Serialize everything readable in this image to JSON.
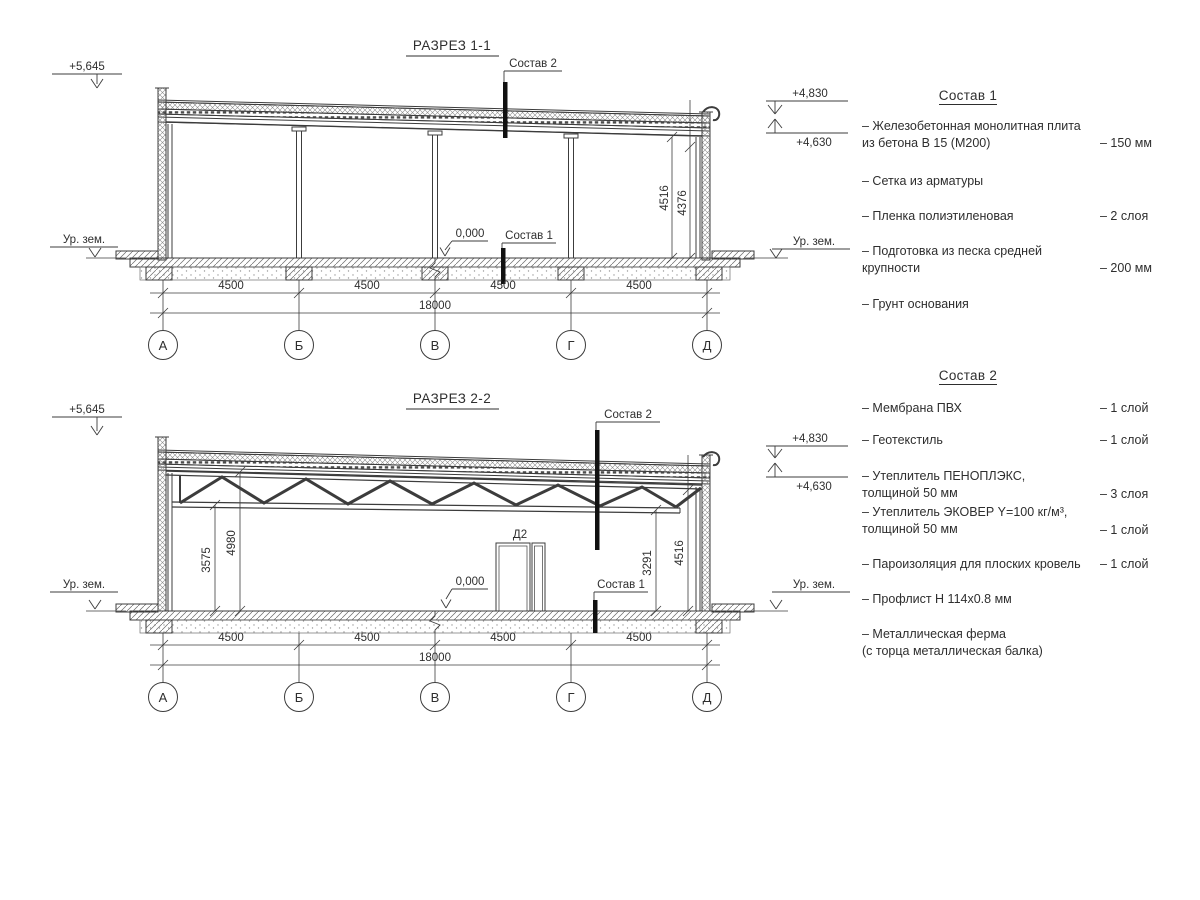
{
  "s1": {
    "title": "РАЗРЕЗ 1-1",
    "callout_top": "Состав 2",
    "callout_bottom": "Состав 1",
    "elev_left": "+5,645",
    "elev_r1": "+4,830",
    "elev_r2": "+4,630",
    "elev_zero": "0,000",
    "ground": "Ур. зем.",
    "vdim1": "4516",
    "vdim2": "4376",
    "span_dims": [
      "4500",
      "4500",
      "4500",
      "4500"
    ],
    "total_dim": "18000",
    "axes": [
      "А",
      "Б",
      "В",
      "Г",
      "Д"
    ]
  },
  "s2": {
    "title": "РАЗРЕЗ 2-2",
    "callout_top": "Состав 2",
    "callout_bottom": "Состав 1",
    "elev_left": "+5,645",
    "elev_r1": "+4,830",
    "elev_r2": "+4,630",
    "elev_zero": "0,000",
    "ground": "Ур. зем.",
    "door_label": "Д2",
    "vdim_left1": "3575",
    "vdim_left2": "4980",
    "vdim_right1": "3291",
    "vdim_right2": "4516",
    "span_dims": [
      "4500",
      "4500",
      "4500",
      "4500"
    ],
    "total_dim": "18000",
    "axes": [
      "А",
      "Б",
      "В",
      "Г",
      "Д"
    ]
  },
  "legend1": {
    "title": "Состав 1",
    "items": [
      {
        "name": "– Железобетонная монолитная плита\nиз бетона В 15 (М200)",
        "value": "– 150 мм"
      },
      {
        "name": "– Сетка из арматуры",
        "value": ""
      },
      {
        "name": "– Пленка полиэтиленовая",
        "value": "– 2 слоя"
      },
      {
        "name": "– Подготовка из песка средней\nкрупности",
        "value": "– 200 мм"
      },
      {
        "name": "– Грунт основания",
        "value": ""
      }
    ]
  },
  "legend2": {
    "title": "Состав 2",
    "items": [
      {
        "name": "– Мембрана ПВХ",
        "value": "– 1 слой"
      },
      {
        "name": "– Геотекстиль",
        "value": "– 1 слой"
      },
      {
        "name": "– Утеплитель ПЕНОПЛЭКС,\nтолщиной 50 мм",
        "value": "– 3 слоя"
      },
      {
        "name": "– Утеплитель ЭКОВЕР Y=100 кг/м³,\nтолщиной 50 мм",
        "value": "– 1 слой"
      },
      {
        "name": "– Пароизоляция для плоских кровель",
        "value": "– 1 слой"
      },
      {
        "name": "– Профлист Н 114х0.8 мм",
        "value": ""
      },
      {
        "name": "– Металлическая ферма\n(с торца металлическая балка)",
        "value": ""
      }
    ]
  }
}
